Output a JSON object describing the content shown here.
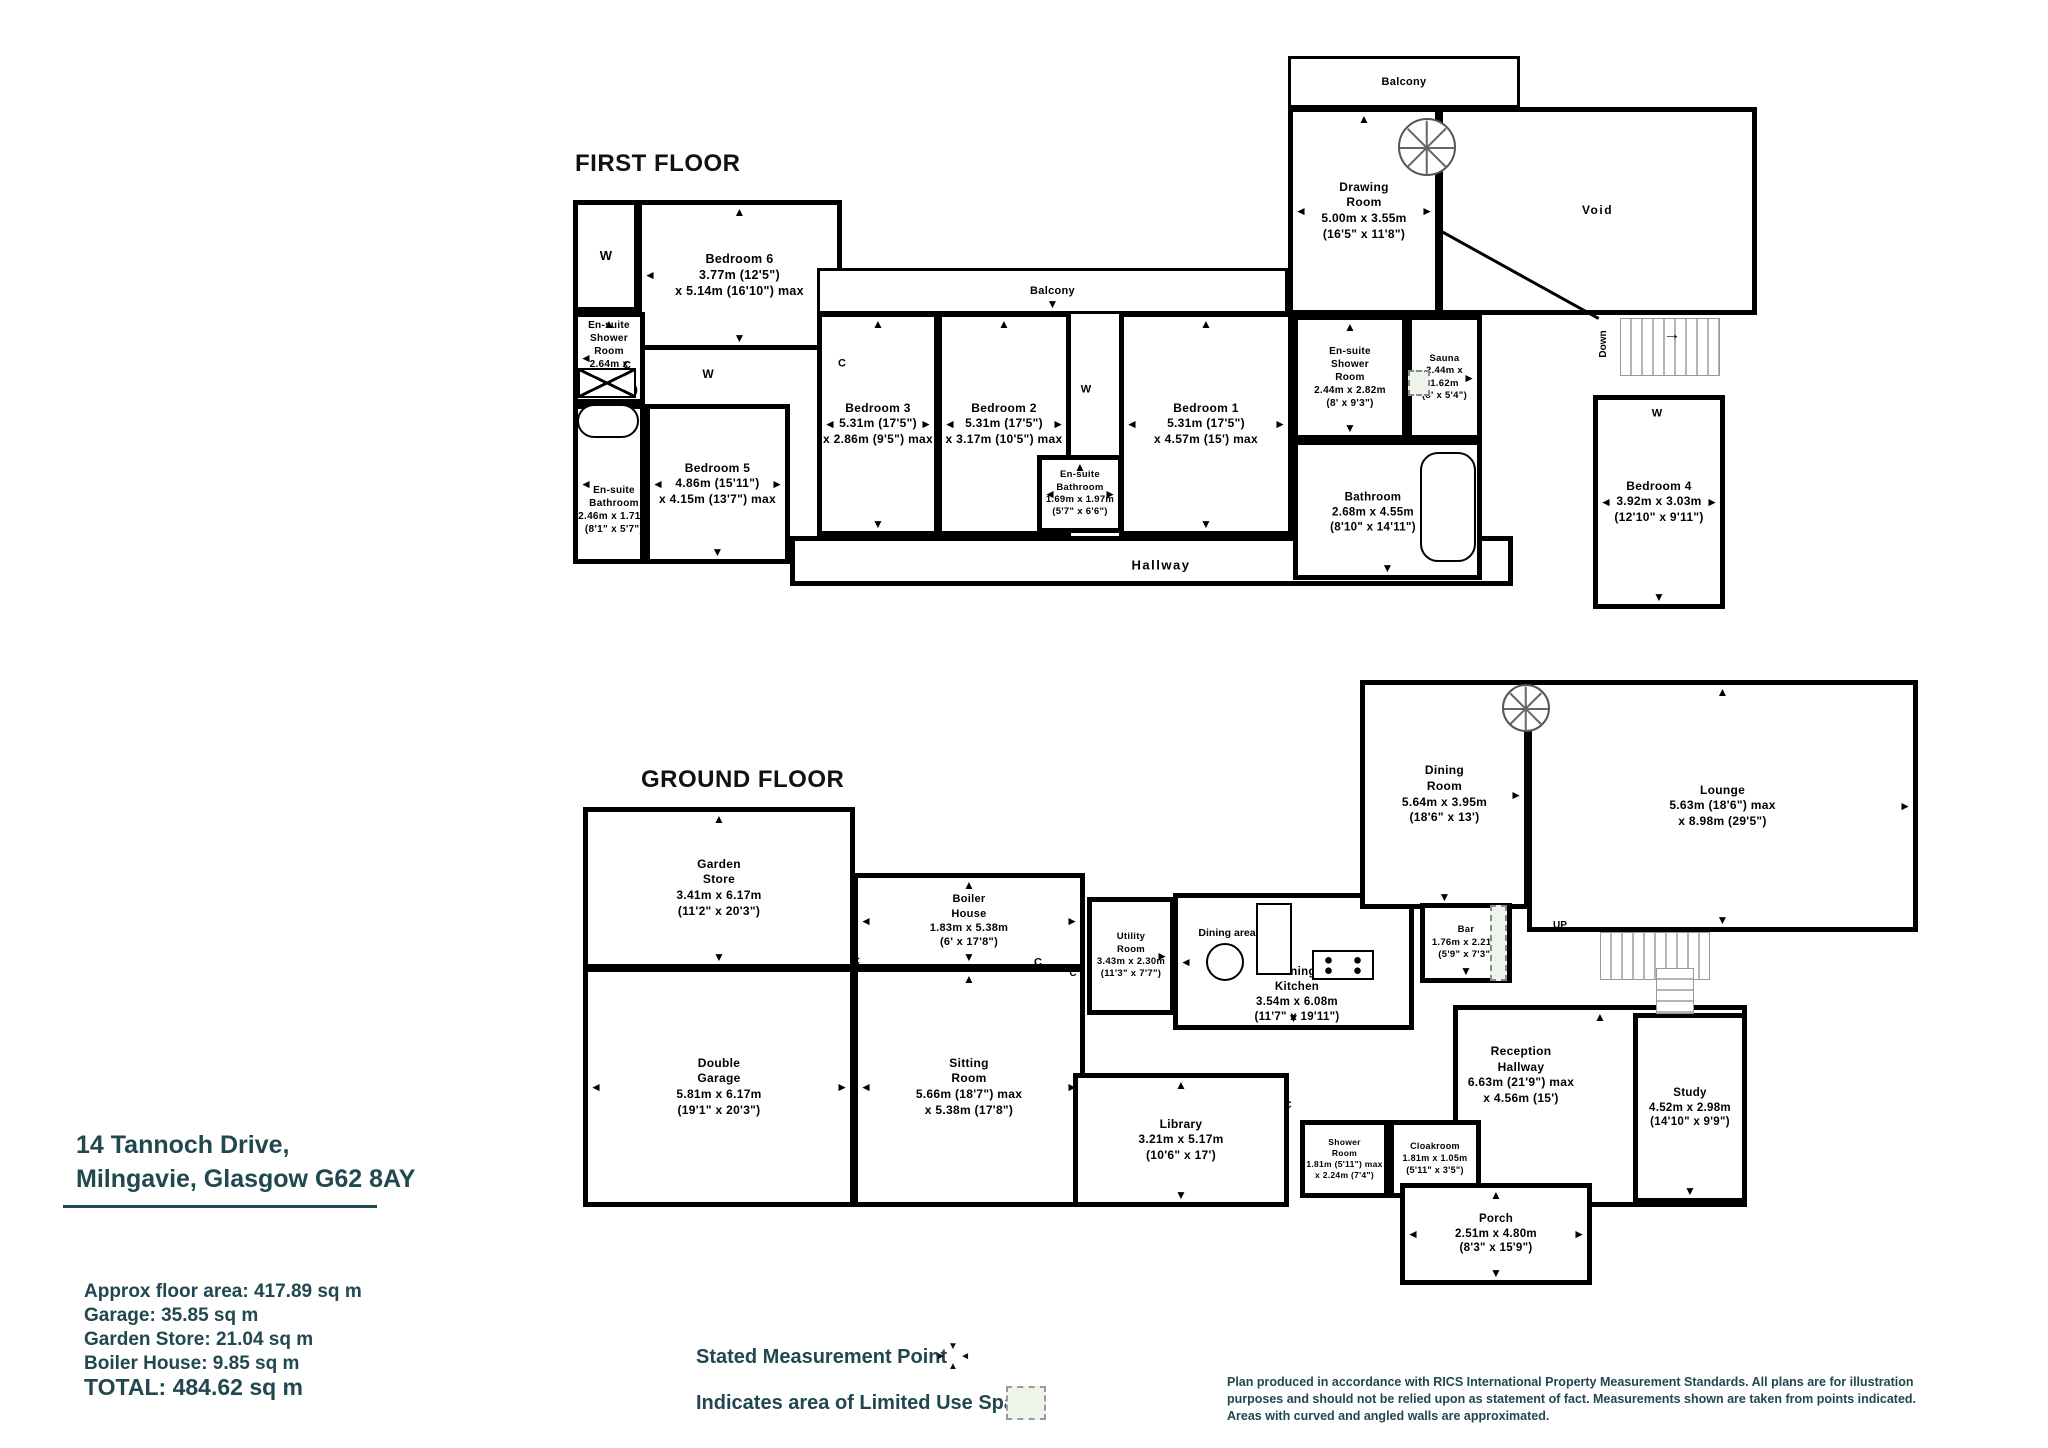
{
  "address": {
    "text": "14 Tannoch Drive,\nMilngavie, Glasgow G62 8AY"
  },
  "areas": {
    "approx": "Approx floor area: 417.89 sq m",
    "garage": "Garage: 35.85 sq m",
    "garden_store": "Garden Store: 21.04 sq m",
    "boiler_house": "Boiler House: 9.85 sq m",
    "total": "TOTAL: 484.62 sq m"
  },
  "legend": {
    "measurement_point": "Stated Measurement Point",
    "limited_use": "Indicates area of  Limited Use Space"
  },
  "disclaimer": {
    "text": "Plan produced  in accordance with RICS International Property  Measurement Standards.  All plans are for illustration\npurposes and should not be relied upon as statement of fact.  Measurements shown are taken from points indicated.\nAreas with curved and angled walls are approximated."
  },
  "colors": {
    "teal": "#20484e",
    "wall": "#000000",
    "limited_use_fill": "#eef4ea",
    "stair_gray": "#b5b5b5"
  },
  "floors": [
    {
      "id": "first-floor",
      "title": "FIRST FLOOR",
      "title_at": [
        575,
        150
      ],
      "rooms": [
        {
          "id": "wardrobe-ff",
          "lines": [
            "W"
          ],
          "x": 573,
          "y": 200,
          "w": 66,
          "h": 112,
          "fs": 13,
          "arrows": []
        },
        {
          "id": "bedroom-6",
          "lines": [
            "Bedroom 6",
            "3.77m (12'5\")",
            "x 5.14m (16'10\") max"
          ],
          "x": 637,
          "y": 200,
          "w": 205,
          "h": 150,
          "fs": 12.5,
          "arrows": [
            "l",
            "r",
            "t",
            "b"
          ]
        },
        {
          "id": "ensuite-shower-room-ff",
          "lines": [
            "En-suite",
            "Shower",
            "Room",
            "2.64m x 1.71m",
            "(8'8\" x 5'7\")"
          ],
          "x": 573,
          "y": 312,
          "w": 72,
          "h": 92,
          "fs": 10,
          "arrows": [
            "l",
            "t"
          ]
        },
        {
          "id": "ensuite-bathroom-ff",
          "lines": [
            "En-suite",
            "Bathroom",
            "2.46m x 1.71m",
            "(8'1\" x 5'7\")"
          ],
          "x": 573,
          "y": 404,
          "w": 72,
          "h": 160,
          "fs": 10,
          "arrows": [
            "l"
          ],
          "label_at": [
            609,
            505
          ]
        },
        {
          "id": "bedroom-5",
          "lines": [
            "Bedroom 5",
            "4.86m (15'11\")",
            "x 4.15m (13'7\") max"
          ],
          "x": 645,
          "y": 404,
          "w": 145,
          "h": 160,
          "fs": 12,
          "arrows": [
            "l",
            "r",
            "b"
          ]
        },
        {
          "id": "balcony-middle",
          "lines": [
            "Balcony"
          ],
          "x": 817,
          "y": 268,
          "w": 471,
          "h": 46,
          "fs": 11,
          "wall": 3,
          "arrows": [
            "b"
          ]
        },
        {
          "id": "bedroom-3",
          "lines": [
            "Bedroom 3",
            "5.31m (17'5\")",
            "x 2.86m (9'5\") max"
          ],
          "x": 817,
          "y": 312,
          "w": 122,
          "h": 224,
          "fs": 12,
          "arrows": [
            "l",
            "r",
            "t",
            "b"
          ]
        },
        {
          "id": "bedroom-2",
          "lines": [
            "Bedroom 2",
            "5.31m (17'5\")",
            "x 3.17m (10'5\") max"
          ],
          "x": 937,
          "y": 312,
          "w": 134,
          "h": 224,
          "fs": 12,
          "arrows": [
            "l",
            "r",
            "t"
          ]
        },
        {
          "id": "bedroom-1",
          "lines": [
            "Bedroom 1",
            "5.31m (17'5\")",
            "x 4.57m (15') max"
          ],
          "x": 1119,
          "y": 312,
          "w": 174,
          "h": 224,
          "fs": 12,
          "arrows": [
            "l",
            "r",
            "t",
            "b"
          ]
        },
        {
          "id": "ensuite-bathroom-middle",
          "lines": [
            "En-suite",
            "Bathroom",
            "1.69m x 1.97m",
            "(5'7\" x 6'6\")"
          ],
          "x": 1037,
          "y": 455,
          "w": 86,
          "h": 78,
          "fs": 9.5,
          "arrows": [
            "l",
            "r",
            "t"
          ]
        },
        {
          "id": "hallway",
          "lines": [
            "Hallway"
          ],
          "x": 790,
          "y": 536,
          "w": 723,
          "h": 50,
          "fs": 13,
          "ls": 1.5,
          "arrows": [],
          "label_at": [
            1156,
            561
          ]
        },
        {
          "id": "balcony-top",
          "lines": [
            "Balcony"
          ],
          "x": 1288,
          "y": 56,
          "w": 232,
          "h": 52,
          "fs": 11,
          "wall": 3,
          "arrows": []
        },
        {
          "id": "drawing-room",
          "lines": [
            "Drawing",
            "Room",
            "5.00m x 3.55m",
            "(16'5\" x 11'8\")"
          ],
          "x": 1288,
          "y": 107,
          "w": 152,
          "h": 208,
          "fs": 12,
          "arrows": [
            "l",
            "r",
            "t"
          ]
        },
        {
          "id": "void",
          "lines": [
            "Void"
          ],
          "x": 1438,
          "y": 107,
          "w": 319,
          "h": 208,
          "fs": 12,
          "ls": 1.5,
          "arrows": []
        },
        {
          "id": "ensuite-shower-room-ff-right",
          "lines": [
            "En-suite",
            "Shower",
            "Room",
            "2.44m x 2.82m",
            "(8' x 9'3\")"
          ],
          "x": 1293,
          "y": 315,
          "w": 114,
          "h": 125,
          "fs": 10,
          "arrows": [
            "t",
            "b"
          ]
        },
        {
          "id": "sauna",
          "lines": [
            "Sauna",
            "2.44m x 1.62m",
            "(8' x 5'4\")"
          ],
          "x": 1407,
          "y": 315,
          "w": 75,
          "h": 125,
          "fs": 9.5,
          "arrows": [
            "l",
            "r"
          ]
        },
        {
          "id": "bathroom-ff",
          "lines": [
            "Bathroom",
            "2.68m x 4.55m",
            "(8'10\" x 14'11\")"
          ],
          "x": 1293,
          "y": 440,
          "w": 189,
          "h": 140,
          "fs": 11.5,
          "arrows": [
            "r",
            "b"
          ],
          "label_at": [
            1368,
            508
          ]
        },
        {
          "id": "bedroom-4",
          "lines": [
            "Bedroom 4",
            "3.92m x 3.03m",
            "(12'10\" x 9'11\")"
          ],
          "x": 1593,
          "y": 395,
          "w": 132,
          "h": 214,
          "fs": 12,
          "arrows": [
            "l",
            "r",
            "b"
          ]
        }
      ],
      "labels": [
        {
          "t": "C",
          "x": 627,
          "y": 366,
          "fs": 11
        },
        {
          "t": "W",
          "x": 708,
          "y": 374,
          "fs": 12
        },
        {
          "t": "C",
          "x": 842,
          "y": 364,
          "fs": 11
        },
        {
          "t": "W",
          "x": 1086,
          "y": 390,
          "fs": 11
        },
        {
          "t": "W",
          "x": 1657,
          "y": 414,
          "fs": 11
        },
        {
          "t": "Down",
          "x": 1604,
          "y": 344,
          "fs": 10,
          "rot": -90
        },
        {
          "t": "→",
          "x": 1672,
          "y": 334,
          "fs": 17
        }
      ],
      "features": [
        {
          "type": "spiral",
          "x": 1398,
          "y": 118,
          "w": 58,
          "h": 58
        },
        {
          "type": "stairs-h",
          "x": 1620,
          "y": 318,
          "w": 100,
          "h": 58
        },
        {
          "type": "diag",
          "x": 1442,
          "y": 230,
          "len": 180,
          "ang": 29
        },
        {
          "type": "tray",
          "x": 578,
          "y": 368,
          "w": 58,
          "h": 30
        },
        {
          "type": "bath",
          "x": 577,
          "y": 404,
          "w": 62,
          "h": 34
        },
        {
          "type": "bath",
          "x": 1420,
          "y": 452,
          "w": 56,
          "h": 110
        },
        {
          "type": "dashed",
          "x": 1408,
          "y": 370,
          "w": 22,
          "h": 26
        }
      ]
    },
    {
      "id": "ground-floor",
      "title": "GROUND FLOOR",
      "title_at": [
        641,
        766
      ],
      "rooms": [
        {
          "id": "garden-store",
          "lines": [
            "Garden",
            "Store",
            "3.41m x 6.17m",
            "(11'2\" x 20'3\")"
          ],
          "x": 583,
          "y": 807,
          "w": 272,
          "h": 162,
          "fs": 12,
          "arrows": [
            "t",
            "b"
          ]
        },
        {
          "id": "double-garage",
          "lines": [
            "Double",
            "Garage",
            "5.81m x 6.17m",
            "(19'1\" x 20'3\")"
          ],
          "x": 583,
          "y": 967,
          "w": 272,
          "h": 240,
          "fs": 12,
          "arrows": [
            "l",
            "r"
          ]
        },
        {
          "id": "boiler-house",
          "lines": [
            "Boiler",
            "House",
            "1.83m x 5.38m",
            "(6' x 17'8\")"
          ],
          "x": 853,
          "y": 873,
          "w": 232,
          "h": 96,
          "fs": 11,
          "arrows": [
            "l",
            "r",
            "t",
            "b"
          ]
        },
        {
          "id": "sitting-room",
          "lines": [
            "Sitting",
            "Room",
            "5.66m (18'7\") max",
            "x 5.38m (17'8\")"
          ],
          "x": 853,
          "y": 967,
          "w": 232,
          "h": 240,
          "fs": 12,
          "arrows": [
            "l",
            "r",
            "t"
          ]
        },
        {
          "id": "utility-room",
          "lines": [
            "Utility",
            "Room",
            "3.43m x 2.30m",
            "(11'3\" x 7'7\")"
          ],
          "x": 1087,
          "y": 897,
          "w": 88,
          "h": 118,
          "fs": 9.5,
          "arrows": [
            "r"
          ]
        },
        {
          "id": "dining-kitchen",
          "lines": [
            "Dining",
            "Kitchen",
            "3.54m x 6.08m",
            "(11'7\" x 19'11\")"
          ],
          "x": 1173,
          "y": 893,
          "w": 241,
          "h": 137,
          "fs": 11.5,
          "arrows": [
            "l",
            "b"
          ],
          "label_at": [
            1292,
            990
          ]
        },
        {
          "id": "dining-room",
          "lines": [
            "Dining",
            "Room",
            "5.64m x 3.95m",
            "(18'6\" x 13')"
          ],
          "x": 1360,
          "y": 680,
          "w": 169,
          "h": 229,
          "fs": 12,
          "arrows": [
            "r",
            "b"
          ]
        },
        {
          "id": "lounge",
          "lines": [
            "Lounge",
            "5.63m (18'6\") max",
            "x 8.98m (29'5\")"
          ],
          "x": 1527,
          "y": 680,
          "w": 391,
          "h": 252,
          "fs": 12,
          "arrows": [
            "t",
            "r",
            "b"
          ]
        },
        {
          "id": "bar",
          "lines": [
            "Bar",
            "1.76m x 2.21m",
            "(5'9\" x 7'3\")"
          ],
          "x": 1420,
          "y": 903,
          "w": 92,
          "h": 80,
          "fs": 9.5,
          "arrows": [
            "b"
          ]
        },
        {
          "id": "reception-hallway",
          "lines": [
            "Reception",
            "Hallway",
            "6.63m (21'9\") max",
            "x 4.56m (15')"
          ],
          "x": 1453,
          "y": 1005,
          "w": 294,
          "h": 202,
          "fs": 12,
          "arrows": [
            "t"
          ],
          "label_at": [
            1516,
            1070
          ]
        },
        {
          "id": "study",
          "lines": [
            "Study",
            "4.52m x 2.98m",
            "(14'10\" x 9'9\")"
          ],
          "x": 1633,
          "y": 1013,
          "w": 114,
          "h": 190,
          "fs": 11.5,
          "arrows": [
            "b"
          ]
        },
        {
          "id": "library",
          "lines": [
            "Library",
            "3.21m x 5.17m",
            "(10'6\" x 17')"
          ],
          "x": 1073,
          "y": 1073,
          "w": 216,
          "h": 134,
          "fs": 12,
          "arrows": [
            "t",
            "b"
          ]
        },
        {
          "id": "shower-room-gf",
          "lines": [
            "Shower",
            "Room",
            "1.81m (5'11\") max",
            "x 2.24m (7'4\")"
          ],
          "x": 1300,
          "y": 1120,
          "w": 89,
          "h": 78,
          "fs": 8.5,
          "arrows": []
        },
        {
          "id": "cloakroom",
          "lines": [
            "Cloakroom",
            "1.81m x 1.05m",
            "(5'11\" x 3'5\")"
          ],
          "x": 1389,
          "y": 1120,
          "w": 92,
          "h": 78,
          "fs": 9,
          "arrows": []
        },
        {
          "id": "porch",
          "lines": [
            "Porch",
            "2.51m x 4.80m",
            "(8'3\" x 15'9\")"
          ],
          "x": 1400,
          "y": 1183,
          "w": 192,
          "h": 102,
          "fs": 11.5,
          "arrows": [
            "l",
            "r",
            "t",
            "b"
          ]
        }
      ],
      "labels": [
        {
          "t": "Dining area",
          "x": 1227,
          "y": 933,
          "fs": 10.5
        },
        {
          "t": "C",
          "x": 856,
          "y": 962,
          "fs": 11
        },
        {
          "t": "C",
          "x": 1038,
          "y": 963,
          "fs": 11
        },
        {
          "t": "C",
          "x": 1073,
          "y": 974,
          "fs": 10
        },
        {
          "t": "C",
          "x": 1288,
          "y": 1106,
          "fs": 10
        },
        {
          "t": "UP",
          "x": 1560,
          "y": 926,
          "fs": 10
        }
      ],
      "features": [
        {
          "type": "spiral",
          "x": 1502,
          "y": 684,
          "w": 48,
          "h": 48
        },
        {
          "type": "stairs-h",
          "x": 1600,
          "y": 932,
          "w": 110,
          "h": 48
        },
        {
          "type": "stairs-v",
          "x": 1656,
          "y": 968,
          "w": 38,
          "h": 46
        },
        {
          "type": "circle",
          "x": 1206,
          "y": 943,
          "w": 38,
          "h": 38
        },
        {
          "type": "counter",
          "x": 1256,
          "y": 903,
          "w": 36,
          "h": 72
        },
        {
          "type": "hob",
          "x": 1312,
          "y": 950,
          "w": 62,
          "h": 30
        },
        {
          "type": "dashed",
          "x": 1490,
          "y": 905,
          "w": 17,
          "h": 76
        }
      ]
    }
  ]
}
